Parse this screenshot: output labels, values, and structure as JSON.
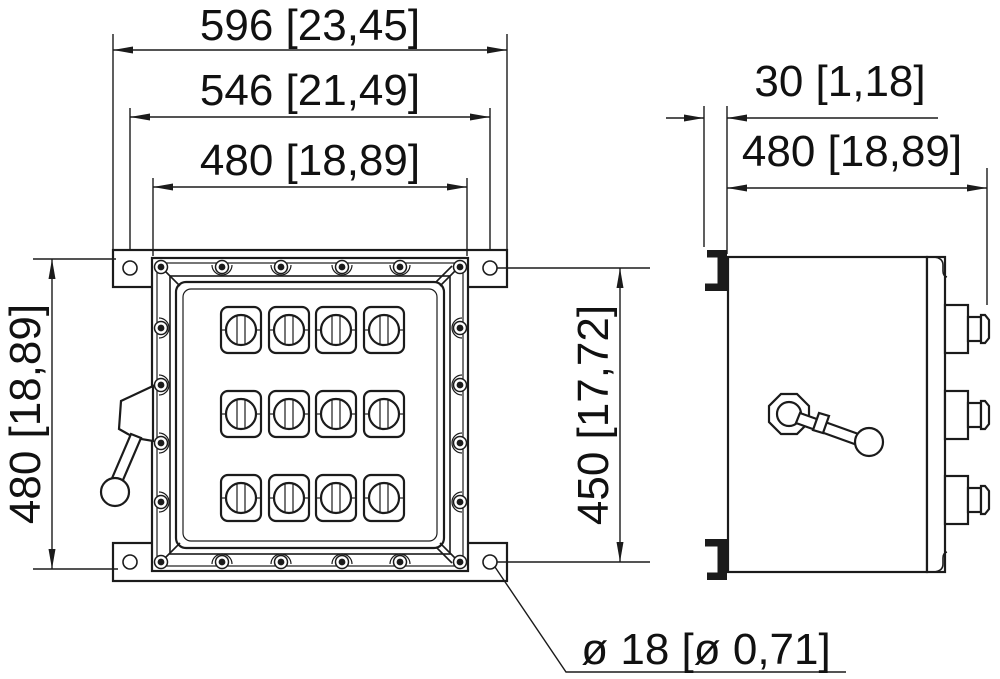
{
  "drawing": {
    "type": "enclosure-dimension-drawing",
    "views": {
      "front_view": "enclosure front with 4x3 operator grid and side lever handle",
      "side_view": "enclosure side with mounting brackets, cable glands and rotary handle"
    },
    "dimensions": {
      "front_overall_width": "596 [23,45]",
      "front_mount_hole_spacing_h": "546 [21,49]",
      "front_body_width": "480 [18,89]",
      "front_body_height": "480 [18,89]",
      "front_mount_hole_spacing_v": "450 [17,72]",
      "side_mount_bracket_depth": "30 [1,18]",
      "side_overall_depth": "480 [18,89]",
      "mount_hole_diameter": "ø 18 [ø 0,71]"
    }
  }
}
